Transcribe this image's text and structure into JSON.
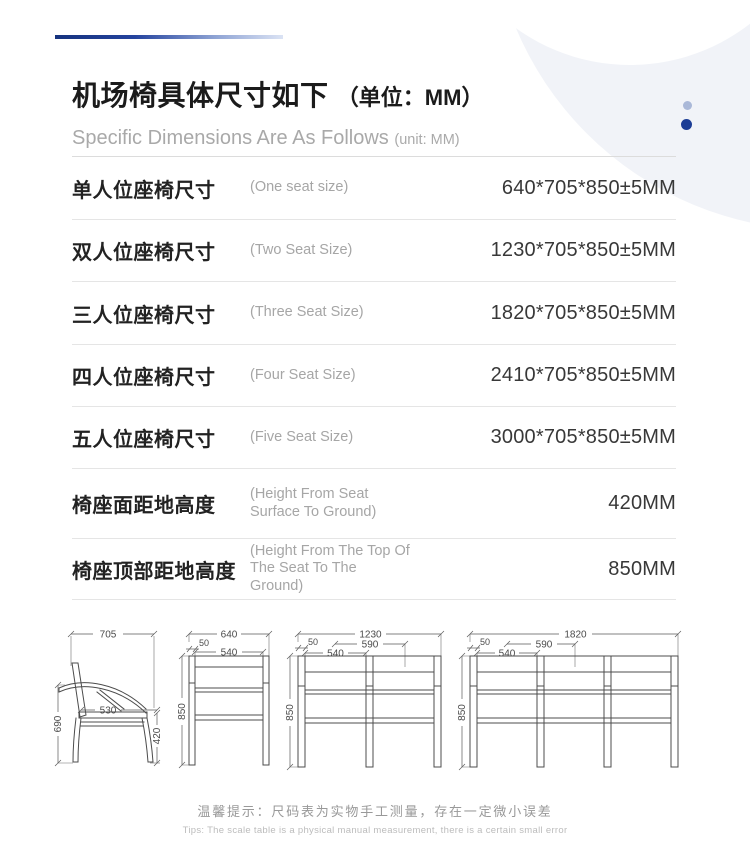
{
  "page": {
    "background": "#ffffff",
    "accent_blue_dark": "#1c3d96",
    "accent_blue_light": "#aab8d8",
    "accent_line_start": "#16337e"
  },
  "header": {
    "title_cn": "机场椅具体尺寸如下",
    "title_unit": "（单位：MM）",
    "subtitle_en": "Specific Dimensions Are As Follows",
    "subtitle_unit": "(unit: MM)"
  },
  "table": {
    "rows": [
      {
        "label_cn": "单人位座椅尺寸",
        "label_en": "(One seat size)",
        "value": "640*705*850±5MM"
      },
      {
        "label_cn": "双人位座椅尺寸",
        "label_en": "(Two Seat Size)",
        "value": "1230*705*850±5MM"
      },
      {
        "label_cn": "三人位座椅尺寸",
        "label_en": "(Three Seat Size)",
        "value": "1820*705*850±5MM"
      },
      {
        "label_cn": "四人位座椅尺寸",
        "label_en": "(Four Seat Size)",
        "value": "2410*705*850±5MM"
      },
      {
        "label_cn": "五人位座椅尺寸",
        "label_en": "(Five Seat Size)",
        "value": "3000*705*850±5MM"
      },
      {
        "label_cn": "椅座面距地高度",
        "label_en": "(Height From Seat Surface To Ground)",
        "value": "420MM"
      },
      {
        "label_cn": "椅座顶部距地高度",
        "label_en": "(Height From The Top Of The Seat To The Ground)",
        "value": "850MM"
      }
    ]
  },
  "diagrams": {
    "side": {
      "width": "705",
      "back_height": "690",
      "seat_depth": "530",
      "seat_height": "420"
    },
    "one_seat": {
      "width": "640",
      "leg_offset": "50",
      "inner_width": "540",
      "height": "850"
    },
    "two_seat": {
      "width": "1230",
      "seat_pitch": "590",
      "inner_width": "540",
      "leg_offset": "50",
      "height": "850"
    },
    "three_seat": {
      "width": "1820",
      "seat_pitch": "590",
      "inner_width": "540",
      "leg_offset": "50",
      "height": "850"
    }
  },
  "footer": {
    "tip_cn": "温馨提示：尺码表为实物手工测量，存在一定微小误差",
    "tip_en": "Tips: The scale table is a physical manual measurement, there is a certain small error"
  }
}
